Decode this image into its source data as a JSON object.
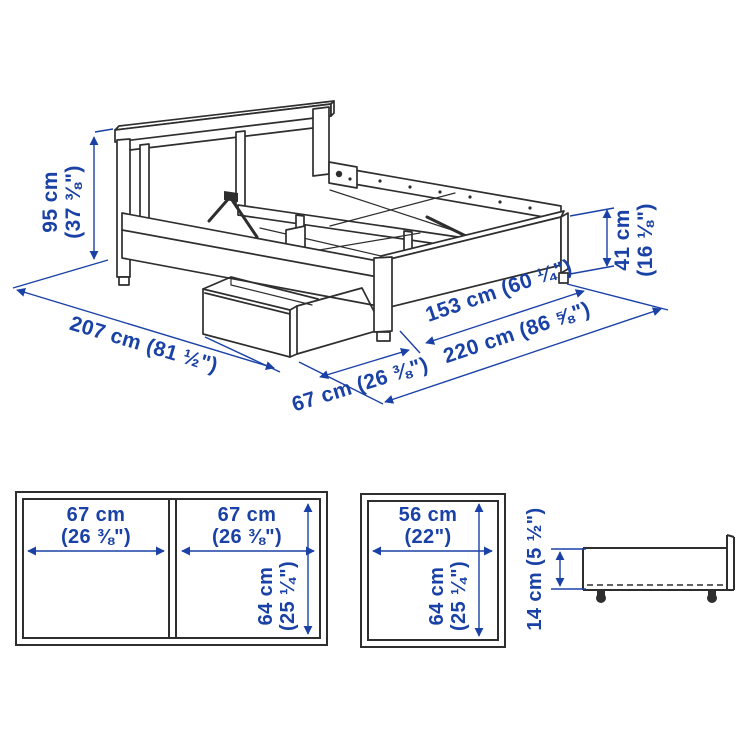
{
  "colors": {
    "dimension_blue": "#1a41a6",
    "line_dark": "#2e2e2e",
    "background": "#ffffff"
  },
  "bed_view": {
    "headboard_height": {
      "metric": "95 cm",
      "imperial": "(37 ⅜\")"
    },
    "footboard_height": {
      "metric": "41 cm",
      "imperial": "(16 ⅛\")"
    },
    "length_label": "207 cm (81 ½\")",
    "box_pullout_label": "67 cm (26 ⅜\")",
    "width_label": "153 cm (60 ¼\")",
    "total_width_label": "220 cm (86 ⅝\")"
  },
  "double_box_top_view": {
    "left_box_width": {
      "metric": "67 cm",
      "imperial": "(26 ⅜\")"
    },
    "right_box_width": {
      "metric": "67 cm",
      "imperial": "(26 ⅜\")"
    },
    "box_depth": {
      "metric": "64 cm",
      "imperial": "(25 ¼\")"
    }
  },
  "single_box_top_view": {
    "box_width": {
      "metric": "56 cm",
      "imperial": "(22\")"
    },
    "box_depth": {
      "metric": "64 cm",
      "imperial": "(25 ¼\")"
    }
  },
  "box_side_view": {
    "box_height_label": "14 cm (5 ½\")"
  }
}
